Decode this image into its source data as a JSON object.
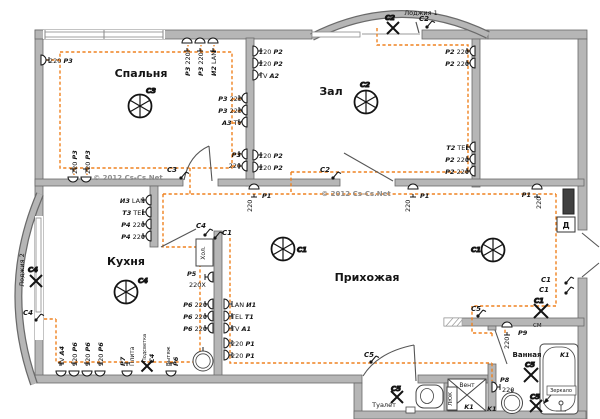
{
  "colors": {
    "wire": "#EF8220",
    "wall": "#b6b6b6",
    "wall_edge": "#6a6a6a",
    "ink": "#141414",
    "watermark": "#8d8d8d",
    "panel": "#404040"
  },
  "labels": [
    {
      "n": "room-label-bedroom",
      "x": 141,
      "y": 77,
      "f": 11,
      "a": "m",
      "s": [
        [
          "Спальня",
          2
        ]
      ]
    },
    {
      "n": "room-label-hall",
      "x": 331,
      "y": 95,
      "f": 11,
      "a": "m",
      "s": [
        [
          "Зал",
          2
        ]
      ]
    },
    {
      "n": "room-label-kitchen",
      "x": 126,
      "y": 265,
      "f": 11,
      "a": "m",
      "s": [
        [
          "Кухня",
          2
        ]
      ]
    },
    {
      "n": "room-label-hallway",
      "x": 367,
      "y": 281,
      "f": 11,
      "a": "m",
      "s": [
        [
          "Прихожая",
          2
        ]
      ]
    },
    {
      "n": "room-label-toilet",
      "x": 384,
      "y": 407,
      "f": 6.5,
      "a": "m",
      "s": [
        [
          "Туалет",
          0
        ]
      ]
    },
    {
      "n": "room-label-bathroom",
      "x": 527,
      "y": 357,
      "f": 7,
      "a": "m",
      "s": [
        [
          "Ванная",
          2
        ]
      ]
    },
    {
      "n": "room-label-loggia1",
      "x": 421,
      "y": 15,
      "f": 6.5,
      "a": "m",
      "s": [
        [
          "Лоджия 1",
          0
        ]
      ]
    },
    {
      "n": "room-label-loggia2",
      "x": 24,
      "y": 270,
      "f": 6.5,
      "a": "m",
      "r": -90,
      "s": [
        [
          "Лоджия 2",
          0
        ]
      ]
    },
    {
      "n": "vent-shaft-label",
      "x": 467,
      "y": 387,
      "f": 6,
      "a": "m",
      "s": [
        [
          "Вент",
          0
        ]
      ]
    },
    {
      "n": "hatch-label",
      "x": 452,
      "y": 399,
      "f": 5.5,
      "a": "m",
      "r": -90,
      "s": [
        [
          "ЛЮК",
          0
        ]
      ]
    },
    {
      "n": "fridge-label",
      "x": 205,
      "y": 253,
      "f": 6,
      "a": "m",
      "r": -90,
      "s": [
        [
          "Хол.",
          0
        ]
      ]
    },
    {
      "n": "doorbell-label",
      "x": 566,
      "y": 228,
      "f": 8,
      "a": "m",
      "s": [
        [
          "Д",
          2
        ]
      ]
    },
    {
      "n": "mirror-label",
      "x": 561,
      "y": 392,
      "f": 5,
      "a": "m",
      "s": [
        [
          "Зеркало",
          0
        ]
      ]
    },
    {
      "n": "watermark-1",
      "x": 128,
      "y": 180,
      "f": 7,
      "a": "m",
      "c": "#8d8d8d",
      "s": [
        [
          "© 2012 Cs-Cs.Net",
          2
        ]
      ]
    },
    {
      "n": "watermark-2",
      "x": 356,
      "y": 196,
      "f": 7,
      "a": "m",
      "c": "#8d8d8d",
      "s": [
        [
          "© 2012 Cs-Cs.Net",
          2
        ]
      ]
    },
    {
      "x": 49,
      "y": 63,
      "s": [
        [
          "220 ",
          0
        ],
        [
          "P3",
          1
        ]
      ]
    },
    {
      "x": 77,
      "y": 174,
      "r": -90,
      "s": [
        [
          "220 ",
          0
        ],
        [
          "P3",
          1
        ]
      ]
    },
    {
      "x": 90,
      "y": 174,
      "r": -90,
      "s": [
        [
          "220 ",
          0
        ],
        [
          "P3",
          1
        ]
      ]
    },
    {
      "x": 190,
      "y": 76,
      "r": -90,
      "s": [
        [
          "P3",
          1
        ],
        [
          " 220",
          0
        ]
      ]
    },
    {
      "x": 203,
      "y": 76,
      "r": -90,
      "s": [
        [
          "P3",
          1
        ],
        [
          " 220",
          0
        ]
      ]
    },
    {
      "x": 216,
      "y": 76,
      "r": -90,
      "s": [
        [
          "И2",
          1
        ],
        [
          " LAN",
          0
        ]
      ]
    },
    {
      "x": 242,
      "y": 101,
      "a": "e",
      "s": [
        [
          "P3",
          1
        ],
        [
          " 220",
          0
        ]
      ]
    },
    {
      "x": 242,
      "y": 113,
      "a": "e",
      "s": [
        [
          "P3",
          1
        ],
        [
          " 220",
          0
        ]
      ]
    },
    {
      "x": 242,
      "y": 125,
      "a": "e",
      "s": [
        [
          "A3",
          1
        ],
        [
          " TV",
          0
        ]
      ]
    },
    {
      "x": 241,
      "y": 157,
      "a": "e",
      "s": [
        [
          "P3",
          1
        ]
      ]
    },
    {
      "x": 241,
      "y": 168,
      "a": "e",
      "s": [
        [
          "220",
          0
        ]
      ]
    },
    {
      "x": 259,
      "y": 54,
      "s": [
        [
          "220 ",
          0
        ],
        [
          "P2",
          1
        ]
      ]
    },
    {
      "x": 259,
      "y": 66,
      "s": [
        [
          "220 ",
          0
        ],
        [
          "P2",
          1
        ]
      ]
    },
    {
      "x": 259,
      "y": 78,
      "s": [
        [
          "TV ",
          0
        ],
        [
          "A2",
          1
        ]
      ]
    },
    {
      "x": 259,
      "y": 158,
      "s": [
        [
          "220 ",
          0
        ],
        [
          "P2",
          1
        ]
      ]
    },
    {
      "x": 259,
      "y": 170,
      "s": [
        [
          "220 ",
          0
        ],
        [
          "P2",
          1
        ]
      ]
    },
    {
      "x": 469,
      "y": 54,
      "a": "e",
      "s": [
        [
          "P2",
          1
        ],
        [
          " 220",
          0
        ]
      ]
    },
    {
      "x": 469,
      "y": 66,
      "a": "e",
      "s": [
        [
          "P2",
          1
        ],
        [
          " 220",
          0
        ]
      ]
    },
    {
      "x": 469,
      "y": 150,
      "a": "e",
      "s": [
        [
          "T2",
          1
        ],
        [
          " TEL",
          0
        ]
      ]
    },
    {
      "x": 469,
      "y": 162,
      "a": "e",
      "s": [
        [
          "P2",
          1
        ],
        [
          " 220",
          0
        ]
      ]
    },
    {
      "x": 469,
      "y": 174,
      "a": "e",
      "s": [
        [
          "P2",
          1
        ],
        [
          " 220",
          0
        ]
      ]
    },
    {
      "x": 262,
      "y": 198,
      "s": [
        [
          "P1",
          1
        ]
      ]
    },
    {
      "x": 252,
      "y": 212,
      "r": -90,
      "s": [
        [
          "220",
          0
        ]
      ]
    },
    {
      "x": 420,
      "y": 198,
      "s": [
        [
          "P1",
          1
        ]
      ]
    },
    {
      "x": 410,
      "y": 212,
      "r": -90,
      "s": [
        [
          "220",
          0
        ]
      ]
    },
    {
      "x": 531,
      "y": 197,
      "a": "e",
      "s": [
        [
          "P1",
          1
        ]
      ]
    },
    {
      "x": 541,
      "y": 209,
      "r": -90,
      "s": [
        [
          "220",
          0
        ]
      ]
    },
    {
      "x": 145,
      "y": 203,
      "a": "e",
      "s": [
        [
          "И3",
          1
        ],
        [
          " LAN",
          0
        ]
      ]
    },
    {
      "x": 145,
      "y": 215,
      "a": "e",
      "s": [
        [
          "T3",
          1
        ],
        [
          " TEL",
          0
        ]
      ]
    },
    {
      "x": 145,
      "y": 227,
      "a": "e",
      "s": [
        [
          "P4",
          1
        ],
        [
          " 220",
          0
        ]
      ]
    },
    {
      "x": 145,
      "y": 239,
      "a": "e",
      "s": [
        [
          "P4",
          1
        ],
        [
          " 220",
          0
        ]
      ]
    },
    {
      "x": 187,
      "y": 276,
      "s": [
        [
          "P5",
          1
        ]
      ]
    },
    {
      "x": 189,
      "y": 287,
      "s": [
        [
          "220X",
          0
        ]
      ]
    },
    {
      "x": 207,
      "y": 307,
      "a": "e",
      "s": [
        [
          "P6",
          1
        ],
        [
          " 220",
          0
        ]
      ]
    },
    {
      "x": 207,
      "y": 319,
      "a": "e",
      "s": [
        [
          "P6",
          1
        ],
        [
          " 220",
          0
        ]
      ]
    },
    {
      "x": 207,
      "y": 331,
      "a": "e",
      "s": [
        [
          "P6",
          1
        ],
        [
          " 220",
          0
        ]
      ]
    },
    {
      "x": 231,
      "y": 307,
      "s": [
        [
          "LAN ",
          0
        ],
        [
          "И1",
          1
        ]
      ]
    },
    {
      "x": 231,
      "y": 319,
      "s": [
        [
          "TEL ",
          0
        ],
        [
          "T1",
          1
        ]
      ]
    },
    {
      "x": 231,
      "y": 331,
      "s": [
        [
          "TV ",
          0
        ],
        [
          "A1",
          1
        ]
      ]
    },
    {
      "x": 231,
      "y": 346,
      "s": [
        [
          "220 ",
          0
        ],
        [
          "P1",
          1
        ]
      ]
    },
    {
      "x": 231,
      "y": 358,
      "s": [
        [
          "220 ",
          0
        ],
        [
          "P1",
          1
        ]
      ]
    },
    {
      "x": 64,
      "y": 366,
      "r": -90,
      "s": [
        [
          "TV ",
          0
        ],
        [
          "A4",
          1
        ]
      ]
    },
    {
      "x": 77,
      "y": 366,
      "r": -90,
      "s": [
        [
          "220 ",
          0
        ],
        [
          "P6",
          1
        ]
      ]
    },
    {
      "x": 90,
      "y": 366,
      "r": -90,
      "s": [
        [
          "220 ",
          0
        ],
        [
          "P6",
          1
        ]
      ]
    },
    {
      "x": 103,
      "y": 366,
      "r": -90,
      "s": [
        [
          "220 ",
          0
        ],
        [
          "P6",
          1
        ]
      ]
    },
    {
      "x": 125,
      "y": 366,
      "r": -90,
      "s": [
        [
          "P7",
          1
        ]
      ]
    },
    {
      "x": 134,
      "y": 366,
      "r": -90,
      "f": 6,
      "s": [
        [
          "Плита",
          0
        ]
      ]
    },
    {
      "x": 146,
      "y": 362,
      "r": -90,
      "f": 5,
      "s": [
        [
          "Подсветка",
          0
        ]
      ]
    },
    {
      "x": 154,
      "y": 363,
      "r": -90,
      "s": [
        [
          "C4",
          1
        ]
      ]
    },
    {
      "x": 170,
      "y": 366,
      "r": -90,
      "f": 5.5,
      "s": [
        [
          "Вытяж",
          0
        ]
      ]
    },
    {
      "x": 178,
      "y": 366,
      "r": -90,
      "s": [
        [
          "P6",
          1
        ]
      ]
    },
    {
      "x": 533,
      "y": 327,
      "f": 5.5,
      "s": [
        [
          "СМ",
          0
        ]
      ]
    },
    {
      "x": 518,
      "y": 335,
      "s": [
        [
          "P9",
          1
        ]
      ]
    },
    {
      "x": 509,
      "y": 349,
      "r": -90,
      "s": [
        [
          "220",
          0
        ]
      ]
    },
    {
      "x": 500,
      "y": 382,
      "s": [
        [
          "P8",
          1
        ]
      ]
    },
    {
      "x": 502,
      "y": 392,
      "s": [
        [
          "220",
          0
        ]
      ]
    },
    {
      "x": 487,
      "y": 411,
      "s": [
        [
          "K1",
          1
        ]
      ]
    },
    {
      "x": 560,
      "y": 357,
      "s": [
        [
          "K1",
          1
        ]
      ]
    },
    {
      "x": 469,
      "y": 409,
      "a": "m",
      "s": [
        [
          "K1",
          1
        ]
      ]
    }
  ],
  "ceiling_lights": [
    {
      "id": "C3",
      "x": 140,
      "y": 106,
      "lx": 146,
      "ly": 93
    },
    {
      "id": "C2",
      "x": 366,
      "y": 102,
      "lx": 360,
      "ly": 87
    },
    {
      "id": "C4",
      "x": 126,
      "y": 292,
      "lx": 138,
      "ly": 283
    },
    {
      "id": "C1",
      "x": 283,
      "y": 249,
      "lx": 297,
      "ly": 252
    },
    {
      "id": "C1",
      "x": 493,
      "y": 250,
      "lx": 481,
      "ly": 252,
      "la": "e"
    }
  ],
  "x_lights": [
    {
      "id": "C2",
      "x": 393,
      "y": 28,
      "sz": 6,
      "lx": 385,
      "ly": 20
    },
    {
      "id": "C4",
      "x": 36,
      "y": 281,
      "sz": 6,
      "lx": 28,
      "ly": 272
    },
    {
      "id": "C4-подсветка",
      "x": 147,
      "y": 366,
      "sz": 5.5
    },
    {
      "id": "C1",
      "x": 541,
      "y": 311,
      "sz": 7,
      "lx": 534,
      "ly": 303
    },
    {
      "id": "C5",
      "x": 397,
      "y": 397,
      "sz": 6,
      "lx": 391,
      "ly": 391
    },
    {
      "id": "C5",
      "x": 531,
      "y": 375,
      "sz": 7,
      "lx": 525,
      "ly": 367
    },
    {
      "id": "C5",
      "x": 536,
      "y": 406,
      "sz": 6,
      "lx": 530,
      "ly": 399
    }
  ],
  "switches": [
    {
      "id": "C3",
      "x": 181,
      "y": 178,
      "lx": 177,
      "ly": 172,
      "la": "e"
    },
    {
      "id": "C2",
      "x": 333,
      "y": 178,
      "lx": 330,
      "ly": 172,
      "la": "e"
    },
    {
      "id": "C2",
      "x": 427,
      "y": 27,
      "lx": 419,
      "ly": 21
    },
    {
      "id": "C4",
      "x": 36,
      "y": 320,
      "lx": 33,
      "ly": 315,
      "la": "e"
    },
    {
      "id": "C4",
      "x": 205,
      "y": 235,
      "lx": 196,
      "ly": 228
    },
    {
      "id": "C1",
      "x": 215,
      "y": 238,
      "lx": 222,
      "ly": 235
    },
    {
      "id": "C5",
      "x": 478,
      "y": 316,
      "lx": 471,
      "ly": 311
    },
    {
      "id": "C5",
      "x": 371,
      "y": 362,
      "lx": 364,
      "ly": 357
    },
    {
      "id": "C1",
      "x": 566,
      "y": 283,
      "lx": 551,
      "ly": 282,
      "la": "e"
    },
    {
      "id": "C1",
      "x": 566,
      "y": 293,
      "lx": 549,
      "ly": 292,
      "la": "e"
    }
  ],
  "points": [
    [
      41,
      60,
      "r"
    ],
    [
      73,
      177,
      "u"
    ],
    [
      86,
      177,
      "u"
    ],
    [
      187,
      43,
      "d"
    ],
    [
      200,
      43,
      "d"
    ],
    [
      213,
      43,
      "d"
    ],
    [
      247,
      98,
      "l"
    ],
    [
      247,
      110,
      "l"
    ],
    [
      247,
      122,
      "l"
    ],
    [
      247,
      154,
      "l"
    ],
    [
      247,
      166,
      "l"
    ],
    [
      253,
      51,
      "r"
    ],
    [
      253,
      63,
      "r"
    ],
    [
      253,
      75,
      "r"
    ],
    [
      253,
      155,
      "r"
    ],
    [
      253,
      167,
      "r"
    ],
    [
      475,
      51,
      "l"
    ],
    [
      475,
      63,
      "l"
    ],
    [
      475,
      147,
      "l"
    ],
    [
      475,
      159,
      "l"
    ],
    [
      475,
      171,
      "l"
    ],
    [
      254,
      189,
      "d"
    ],
    [
      413,
      189,
      "d"
    ],
    [
      537,
      189,
      "d"
    ],
    [
      151,
      200,
      "l"
    ],
    [
      151,
      212,
      "l"
    ],
    [
      151,
      224,
      "l"
    ],
    [
      151,
      236,
      "l"
    ],
    [
      213,
      277,
      "l"
    ],
    [
      213,
      304,
      "l"
    ],
    [
      213,
      316,
      "l"
    ],
    [
      213,
      328,
      "l"
    ],
    [
      224,
      304,
      "r"
    ],
    [
      224,
      316,
      "r"
    ],
    [
      224,
      328,
      "r"
    ],
    [
      224,
      343,
      "r"
    ],
    [
      224,
      355,
      "r"
    ],
    [
      61,
      371,
      "u"
    ],
    [
      74,
      371,
      "u"
    ],
    [
      87,
      371,
      "u"
    ],
    [
      100,
      371,
      "u"
    ],
    [
      127,
      371,
      "u"
    ],
    [
      171,
      371,
      "u"
    ],
    [
      507,
      327,
      "d"
    ],
    [
      492,
      387,
      "r"
    ]
  ]
}
